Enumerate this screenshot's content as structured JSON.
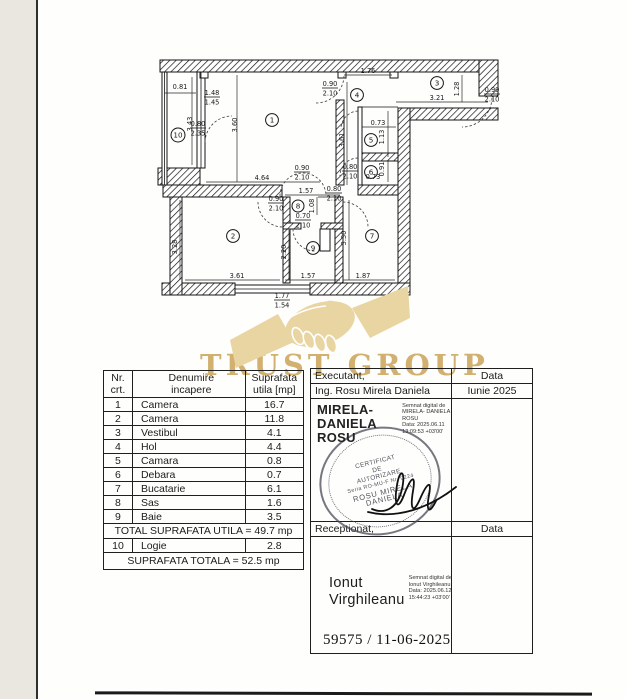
{
  "watermark": {
    "brand": "TRUST GROUP"
  },
  "plan": {
    "rooms": [
      {
        "n": "1"
      },
      {
        "n": "2"
      },
      {
        "n": "3"
      },
      {
        "n": "4"
      },
      {
        "n": "5"
      },
      {
        "n": "6"
      },
      {
        "n": "7"
      },
      {
        "n": "8"
      },
      {
        "n": "9"
      },
      {
        "n": "10"
      }
    ],
    "dims": [
      {
        "t": "0.81"
      },
      {
        "t": "3.43"
      },
      {
        "t": "3.60"
      },
      {
        "t": "4.64"
      },
      {
        "t": "1.76"
      },
      {
        "t": "3.61"
      },
      {
        "t": "1.28"
      },
      {
        "t": "3.21"
      },
      {
        "t": "0.73"
      },
      {
        "t": "1.13"
      },
      {
        "t": "0.91"
      },
      {
        "t": "0.73"
      },
      {
        "t": "1.57"
      },
      {
        "t": "1.08"
      },
      {
        "t": "2.20"
      },
      {
        "t": "3.30"
      },
      {
        "t": "3.28"
      },
      {
        "t": "3.61"
      },
      {
        "t": "1.57"
      },
      {
        "t": "1.87"
      }
    ],
    "fracs": [
      {
        "a": "1.48",
        "b": "1.45"
      },
      {
        "a": "0.80",
        "b": "2.35"
      },
      {
        "a": "0.90",
        "b": "2.10"
      },
      {
        "a": "0.90",
        "b": "2.10"
      },
      {
        "a": "0.80",
        "b": "2.10"
      },
      {
        "a": "0.90",
        "b": "2.10"
      },
      {
        "a": "0.90",
        "b": "2.10"
      },
      {
        "a": "0.80",
        "b": "2.10"
      },
      {
        "a": "0.70",
        "b": "2.10"
      },
      {
        "a": "1.77",
        "b": "1.54"
      }
    ]
  },
  "rooms_table": {
    "headers": [
      [
        "Nr.",
        "crt."
      ],
      [
        "Denumire",
        "incapere"
      ],
      [
        "Suprafata",
        "utila [mp]"
      ]
    ],
    "rows": [
      [
        "1",
        "Camera",
        "16.7"
      ],
      [
        "2",
        "Camera",
        "11.8"
      ],
      [
        "3",
        "Vestibul",
        "4.1"
      ],
      [
        "4",
        "Hol",
        "4.4"
      ],
      [
        "5",
        "Camara",
        "0.8"
      ],
      [
        "6",
        "Debara",
        "0.7"
      ],
      [
        "7",
        "Bucatarie",
        "6.1"
      ],
      [
        "8",
        "Sas",
        "1.6"
      ],
      [
        "9",
        "Baie",
        "3.5"
      ]
    ],
    "total_utila": "TOTAL SUPRAFATA UTILA = 49.7 mp",
    "row10": [
      "10",
      "Logie",
      "2.8"
    ],
    "total": "SUPRAFATA TOTALA = 52.5 mp"
  },
  "sign_table": {
    "executant_label": "Executant,",
    "data_label": "Data",
    "executant_name": "Ing. Rosu Mirela Daniela",
    "date": "Iunie 2025",
    "rosu_sig": {
      "name1": "MIRELA-DANIELA",
      "name2": "ROSU",
      "sm1": "Semnat digital de MIRELA-",
      "sm2": "DANIELA ROSU",
      "sm3": "Data: 2025.06.11 13:09:53 +03'00'"
    },
    "stamp": {
      "l1": "CERTIFICAT",
      "l2": "DE",
      "l3": "AUTORIZARE",
      "l4": "Seria RO-MU-F Nr. 0224",
      "l5": "ROSU MIRELA",
      "l6": "DANIELA"
    },
    "receptionat_label": "Receptionat,",
    "data_label2": "Data",
    "ionut_sig": {
      "name1": "Ionut",
      "name2": "Virghileanu",
      "sm1": "Semnat digital de",
      "sm2": "Ionut Virghileanu",
      "sm3": "Data: 2025.06.12",
      "sm4": "15:44:23 +03'00'"
    },
    "reference": "59575 / 11-06-2025"
  }
}
